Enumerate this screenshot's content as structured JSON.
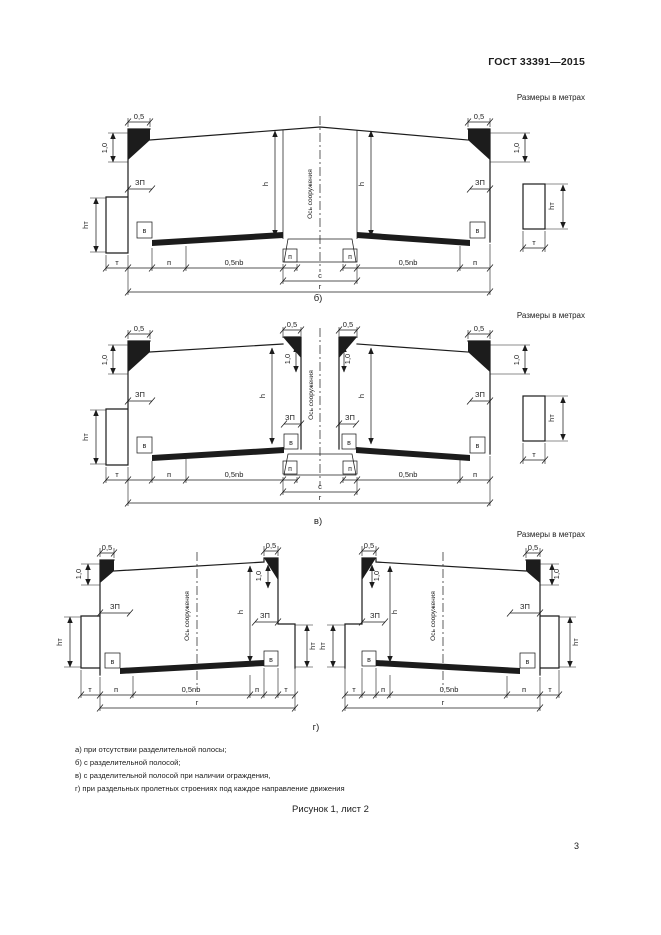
{
  "header": {
    "standard": "ГОСТ 33391—2015"
  },
  "units_note": "Размеры в метрах",
  "labels": {
    "dim05": "0,5",
    "dim10": "1,0",
    "zp": "ЗП",
    "h": "h",
    "ht": "hт",
    "axis": "Ось сооружения",
    "v": "в",
    "t": "т",
    "p": "п",
    "halfnb": "0,5nb",
    "c": "с",
    "g": "г"
  },
  "figures": {
    "b": "б)",
    "v": "в)",
    "g": "г)"
  },
  "footnotes": [
    "а) при отсутствии разделительной полосы;",
    "б) с разделительной полосой;",
    "в) с разделительной полосой при наличии ограждения,",
    "г) при раздельных пролетных строениях под каждое направление движения"
  ],
  "caption": "Рисунок 1, лист 2",
  "page_number": "3"
}
